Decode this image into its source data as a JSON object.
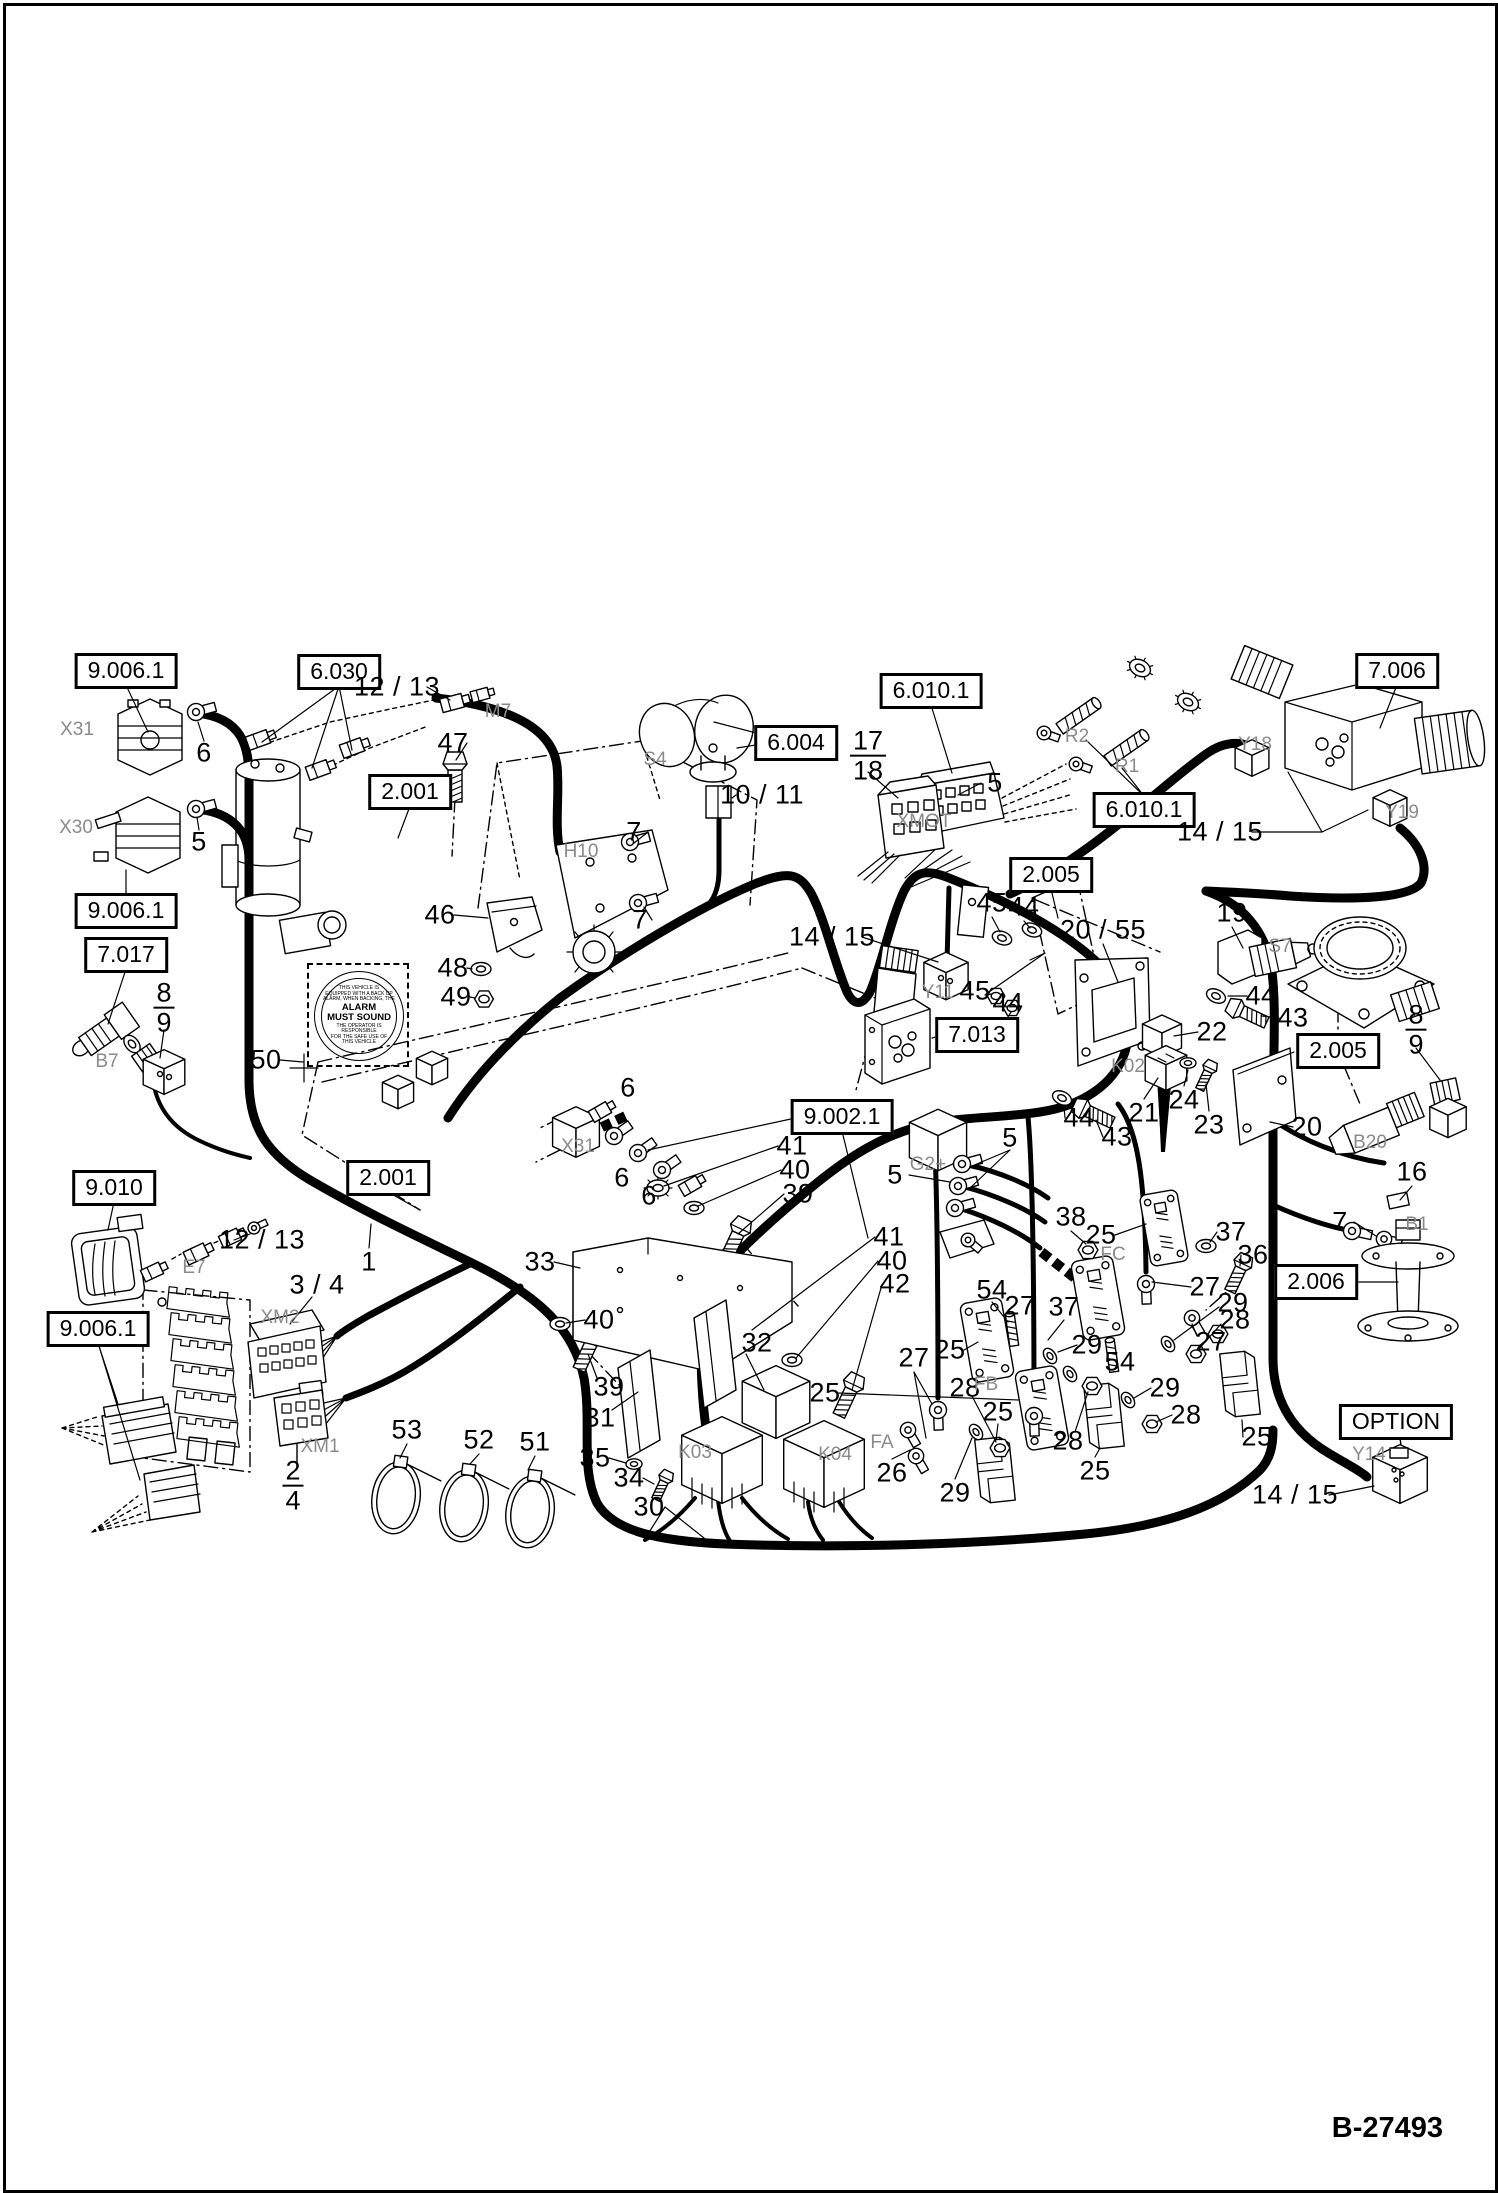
{
  "page": {
    "figure_code": "B-27493"
  },
  "decal": {
    "line1": "THIS VEHICLE IS",
    "line2": "EQUIPPED WITH A BACK UP",
    "line3": "ALARM, WHEN BACKING, THE",
    "main1": "ALARM",
    "main2": "MUST SOUND",
    "line4": "THE OPERATOR IS RESPONSIBLE",
    "line5": "FOR THE SAFE USE OF",
    "line6": "THIS VEHICLE"
  },
  "labels": {
    "boxed": [
      {
        "text": "9.006.1",
        "x": 126,
        "y": 671
      },
      {
        "text": "6.030",
        "x": 339,
        "y": 672
      },
      {
        "text": "2.001",
        "x": 410,
        "y": 792
      },
      {
        "text": "6.004",
        "x": 796,
        "y": 743
      },
      {
        "text": "6.010.1",
        "x": 931,
        "y": 691
      },
      {
        "text": "7.006",
        "x": 1397,
        "y": 671
      },
      {
        "text": "6.010.1",
        "x": 1144,
        "y": 810
      },
      {
        "text": "2.005",
        "x": 1051,
        "y": 875
      },
      {
        "text": "9.006.1",
        "x": 126,
        "y": 911
      },
      {
        "text": "7.017",
        "x": 126,
        "y": 955
      },
      {
        "text": "7.013",
        "x": 977,
        "y": 1035
      },
      {
        "text": "2.005",
        "x": 1338,
        "y": 1051
      },
      {
        "text": "9.002.1",
        "x": 842,
        "y": 1117
      },
      {
        "text": "9.010",
        "x": 114,
        "y": 1188
      },
      {
        "text": "2.001",
        "x": 388,
        "y": 1178
      },
      {
        "text": "9.006.1",
        "x": 98,
        "y": 1329
      },
      {
        "text": "2.006",
        "x": 1316,
        "y": 1282
      },
      {
        "text": "OPTION",
        "x": 1396,
        "y": 1422
      }
    ],
    "callouts": [
      {
        "text": "6",
        "x": 204,
        "y": 753
      },
      {
        "text": "5",
        "x": 199,
        "y": 842
      },
      {
        "text": "12 / 13",
        "x": 397,
        "y": 687
      },
      {
        "text": "47",
        "x": 453,
        "y": 743
      },
      {
        "text": "46",
        "x": 440,
        "y": 915
      },
      {
        "text": "48",
        "x": 453,
        "y": 968
      },
      {
        "text": "49",
        "x": 456,
        "y": 997
      },
      {
        "text": "50",
        "x": 266,
        "y": 1060
      },
      {
        "text": "7",
        "x": 634,
        "y": 832
      },
      {
        "text": "7",
        "x": 640,
        "y": 920
      },
      {
        "text": "10 / 11",
        "x": 762,
        "y": 795
      },
      {
        "text": "5",
        "x": 995,
        "y": 783
      },
      {
        "text": "14 / 15",
        "x": 832,
        "y": 937
      },
      {
        "text": "45",
        "x": 992,
        "y": 903
      },
      {
        "text": "44",
        "x": 1024,
        "y": 907
      },
      {
        "text": "45",
        "x": 975,
        "y": 991
      },
      {
        "text": "44",
        "x": 1008,
        "y": 1003
      },
      {
        "text": "44",
        "x": 1261,
        "y": 996
      },
      {
        "text": "43",
        "x": 1293,
        "y": 1018
      },
      {
        "text": "20 / 55",
        "x": 1103,
        "y": 930
      },
      {
        "text": "19",
        "x": 1232,
        "y": 913
      },
      {
        "text": "22",
        "x": 1212,
        "y": 1032
      },
      {
        "text": "24",
        "x": 1184,
        "y": 1100
      },
      {
        "text": "23",
        "x": 1209,
        "y": 1125
      },
      {
        "text": "21",
        "x": 1144,
        "y": 1113
      },
      {
        "text": "44",
        "x": 1079,
        "y": 1118
      },
      {
        "text": "43",
        "x": 1117,
        "y": 1137
      },
      {
        "text": "20",
        "x": 1307,
        "y": 1127
      },
      {
        "text": "16",
        "x": 1412,
        "y": 1172
      },
      {
        "text": "7",
        "x": 1340,
        "y": 1222
      },
      {
        "text": "14 / 15",
        "x": 1220,
        "y": 832
      },
      {
        "text": "12 / 13",
        "x": 262,
        "y": 1240
      },
      {
        "text": "1",
        "x": 369,
        "y": 1262
      },
      {
        "text": "3 / 4",
        "x": 317,
        "y": 1285
      },
      {
        "text": "53",
        "x": 407,
        "y": 1430
      },
      {
        "text": "52",
        "x": 479,
        "y": 1440
      },
      {
        "text": "51",
        "x": 535,
        "y": 1442
      },
      {
        "text": "33",
        "x": 540,
        "y": 1262
      },
      {
        "text": "41",
        "x": 792,
        "y": 1146
      },
      {
        "text": "40",
        "x": 795,
        "y": 1170
      },
      {
        "text": "39",
        "x": 798,
        "y": 1194
      },
      {
        "text": "6",
        "x": 628,
        "y": 1088
      },
      {
        "text": "6",
        "x": 622,
        "y": 1178
      },
      {
        "text": "6",
        "x": 649,
        "y": 1196
      },
      {
        "text": "5",
        "x": 895,
        "y": 1175
      },
      {
        "text": "5",
        "x": 1010,
        "y": 1138
      },
      {
        "text": "41",
        "x": 889,
        "y": 1237
      },
      {
        "text": "40",
        "x": 892,
        "y": 1261
      },
      {
        "text": "42",
        "x": 895,
        "y": 1284
      },
      {
        "text": "40",
        "x": 599,
        "y": 1320
      },
      {
        "text": "39",
        "x": 609,
        "y": 1387
      },
      {
        "text": "31",
        "x": 600,
        "y": 1418
      },
      {
        "text": "32",
        "x": 757,
        "y": 1343
      },
      {
        "text": "35",
        "x": 595,
        "y": 1458
      },
      {
        "text": "34",
        "x": 629,
        "y": 1478
      },
      {
        "text": "30",
        "x": 649,
        "y": 1507
      },
      {
        "text": "25",
        "x": 825,
        "y": 1393
      },
      {
        "text": "26",
        "x": 892,
        "y": 1473
      },
      {
        "text": "27",
        "x": 914,
        "y": 1358
      },
      {
        "text": "29",
        "x": 955,
        "y": 1493
      },
      {
        "text": "28",
        "x": 965,
        "y": 1388
      },
      {
        "text": "25",
        "x": 950,
        "y": 1350
      },
      {
        "text": "54",
        "x": 992,
        "y": 1290
      },
      {
        "text": "25",
        "x": 998,
        "y": 1412
      },
      {
        "text": "27",
        "x": 1020,
        "y": 1306
      },
      {
        "text": "37",
        "x": 1064,
        "y": 1307
      },
      {
        "text": "29",
        "x": 1087,
        "y": 1345
      },
      {
        "text": "54",
        "x": 1120,
        "y": 1362
      },
      {
        "text": "28",
        "x": 1068,
        "y": 1441
      },
      {
        "text": "25",
        "x": 1095,
        "y": 1471
      },
      {
        "text": "38",
        "x": 1071,
        "y": 1217
      },
      {
        "text": "25",
        "x": 1101,
        "y": 1235
      },
      {
        "text": "37",
        "x": 1231,
        "y": 1232
      },
      {
        "text": "36",
        "x": 1253,
        "y": 1255
      },
      {
        "text": "27",
        "x": 1205,
        "y": 1287
      },
      {
        "text": "29",
        "x": 1233,
        "y": 1303
      },
      {
        "text": "28",
        "x": 1235,
        "y": 1320
      },
      {
        "text": "27",
        "x": 1211,
        "y": 1342
      },
      {
        "text": "29",
        "x": 1165,
        "y": 1388
      },
      {
        "text": "28",
        "x": 1186,
        "y": 1415
      },
      {
        "text": "25",
        "x": 1257,
        "y": 1437
      },
      {
        "text": "14 / 15",
        "x": 1295,
        "y": 1495
      }
    ],
    "fractions": [
      {
        "top": "17",
        "bottom": "18",
        "x": 868,
        "y": 756
      },
      {
        "top": "8",
        "bottom": "9",
        "x": 164,
        "y": 1008
      },
      {
        "top": "8",
        "bottom": "9",
        "x": 1416,
        "y": 1030
      },
      {
        "top": "2",
        "bottom": "4",
        "x": 293,
        "y": 1486
      }
    ],
    "component_ids": [
      {
        "text": "X31",
        "x": 77,
        "y": 730
      },
      {
        "text": "X30",
        "x": 76,
        "y": 828
      },
      {
        "text": "M7",
        "x": 498,
        "y": 712
      },
      {
        "text": "S4",
        "x": 655,
        "y": 760
      },
      {
        "text": "H10",
        "x": 581,
        "y": 852
      },
      {
        "text": "XMOT",
        "x": 924,
        "y": 822
      },
      {
        "text": "R2",
        "x": 1077,
        "y": 737
      },
      {
        "text": "R1",
        "x": 1127,
        "y": 767
      },
      {
        "text": "Y18",
        "x": 1255,
        "y": 745
      },
      {
        "text": "Y19",
        "x": 1402,
        "y": 813
      },
      {
        "text": "B7",
        "x": 107,
        "y": 1062
      },
      {
        "text": "Y11",
        "x": 938,
        "y": 993
      },
      {
        "text": "S7",
        "x": 1280,
        "y": 947
      },
      {
        "text": "K02",
        "x": 1128,
        "y": 1067
      },
      {
        "text": "B20",
        "x": 1370,
        "y": 1143
      },
      {
        "text": "X31",
        "x": 578,
        "y": 1147
      },
      {
        "text": "G2+",
        "x": 928,
        "y": 1165
      },
      {
        "text": "E7",
        "x": 194,
        "y": 1268
      },
      {
        "text": "XM2",
        "x": 280,
        "y": 1318
      },
      {
        "text": "XM1",
        "x": 320,
        "y": 1447
      },
      {
        "text": "K03",
        "x": 695,
        "y": 1453
      },
      {
        "text": "K04",
        "x": 835,
        "y": 1455
      },
      {
        "text": "FA",
        "x": 882,
        "y": 1443
      },
      {
        "text": "FB",
        "x": 986,
        "y": 1385
      },
      {
        "text": "FC",
        "x": 1113,
        "y": 1255
      },
      {
        "text": "B1",
        "x": 1417,
        "y": 1225
      },
      {
        "text": "Y14",
        "x": 1369,
        "y": 1455
      }
    ]
  }
}
